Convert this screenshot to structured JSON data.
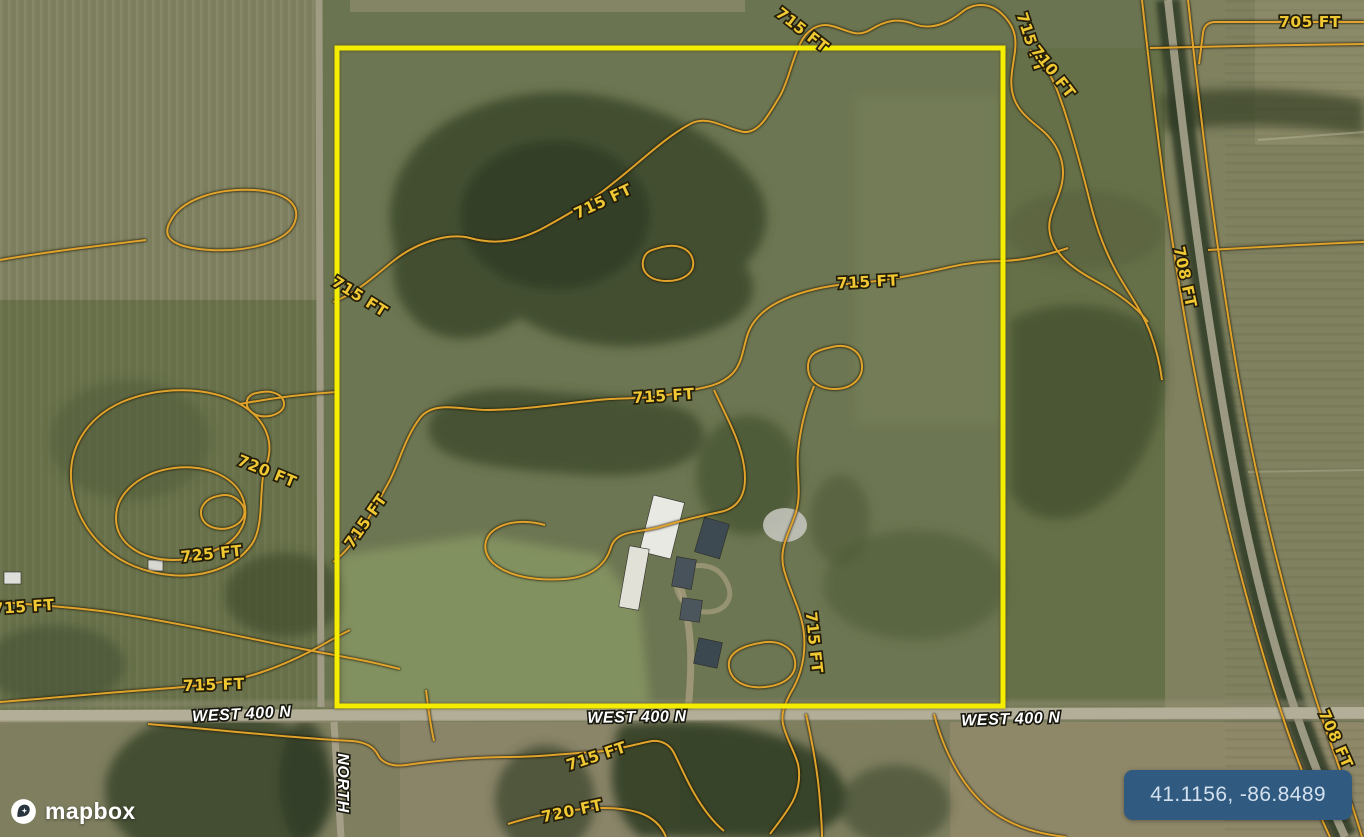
{
  "map": {
    "colors": {
      "boundary_yellow": "#f5ed00",
      "contour_orange": "#e0a32b",
      "contour_label_yellow": "#efc833",
      "badge_background": "#305a80",
      "badge_text": "#d3e1ee"
    },
    "contour_labels": [
      {
        "text": "705 FT"
      },
      {
        "text": "715 FT"
      },
      {
        "text": "715 FT"
      },
      {
        "text": "710 FT"
      },
      {
        "text": "708 FT"
      },
      {
        "text": "715 FT"
      },
      {
        "text": "715 FT"
      },
      {
        "text": "715 FT"
      },
      {
        "text": "715 FT"
      },
      {
        "text": "720 FT"
      },
      {
        "text": "725 FT"
      },
      {
        "text": "715 FT"
      },
      {
        "text": "715 FT"
      },
      {
        "text": "715 FT"
      },
      {
        "text": "715 FT"
      },
      {
        "text": "715 FT"
      },
      {
        "text": "720 FT"
      },
      {
        "text": "708 FT"
      }
    ],
    "road_labels": [
      {
        "text": "WEST 400 N"
      },
      {
        "text": "WEST 400 N"
      },
      {
        "text": "WEST 400 N"
      },
      {
        "text": "NORTH"
      }
    ]
  },
  "attribution": {
    "logo_text": "mapbox"
  },
  "coordinate_badge": {
    "value": "41.1156, -86.8489"
  }
}
